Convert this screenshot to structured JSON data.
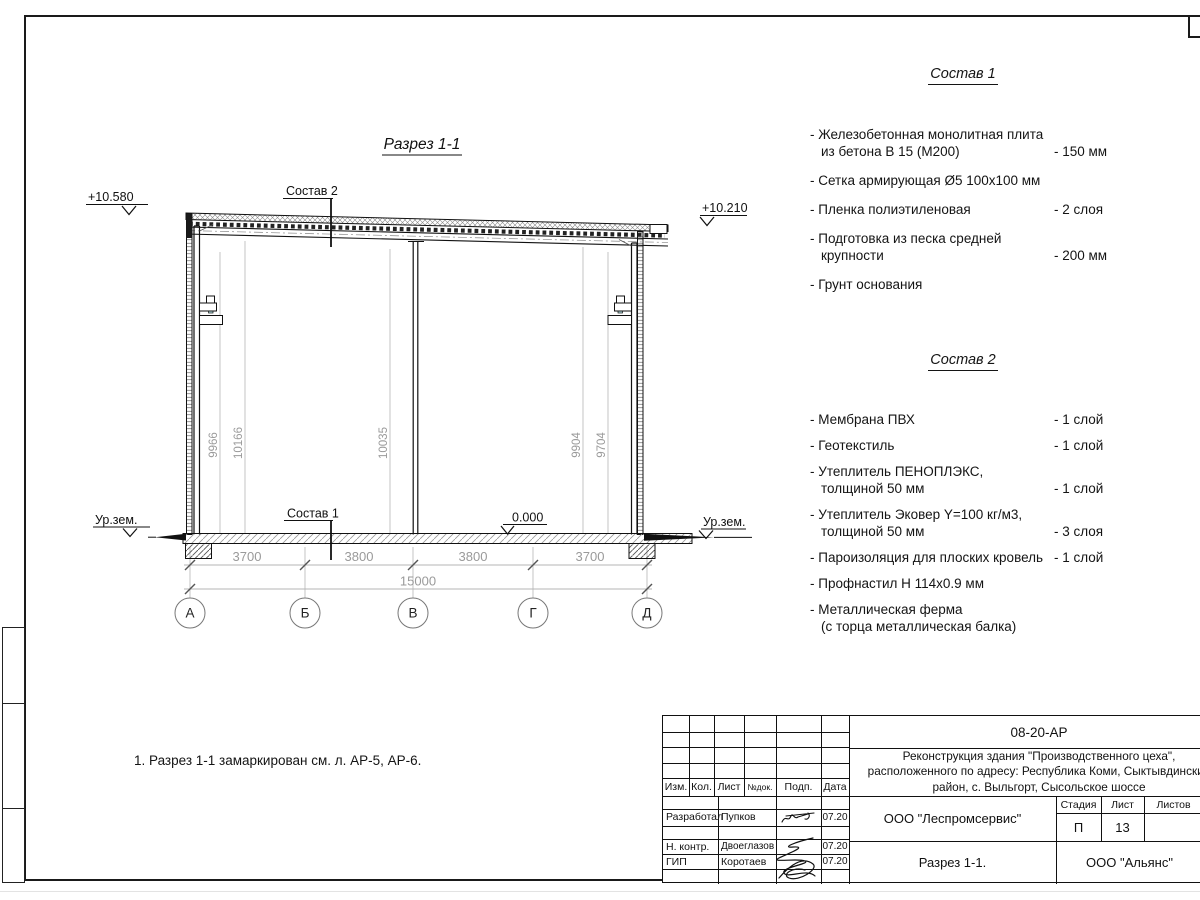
{
  "colors": {
    "line": "#1a1a1a",
    "dim_gray": "#9a9a9a",
    "bracket_accent": "#b7e4e6"
  },
  "drawing": {
    "title": "Разрез 1-1",
    "labels": {
      "comp2_ref": "Состав 2",
      "comp1_ref": "Состав 1"
    },
    "elevations": {
      "left_top": "+10.580",
      "right_top": "+10.210",
      "floor": "0.000",
      "ground_left": "Ур.зем.",
      "ground_right": "Ур.зем."
    },
    "vertical_dims": [
      "9966",
      "10166",
      "10035",
      "9904",
      "9704"
    ],
    "dims_row1": [
      "3700",
      "3800",
      "3800",
      "3700"
    ],
    "dim_total": "15000",
    "axes": [
      "А",
      "Б",
      "В",
      "Г",
      "Д"
    ]
  },
  "comp1": {
    "title": "Состав 1",
    "items": [
      {
        "name": "- Железобетонная  монолитная плита\nиз бетона В 15 (М200)",
        "value": "- 150 мм"
      },
      {
        "name": "- Сетка армирующая Ø5 100х100 мм",
        "value": ""
      },
      {
        "name": "- Пленка полиэтиленовая",
        "value": "-  2 слоя"
      },
      {
        "name": "- Подготовка из песка средней\nкрупности",
        "value": "- 200 мм"
      },
      {
        "name": "- Грунт основания",
        "value": ""
      }
    ]
  },
  "comp2": {
    "title": "Состав 2",
    "items": [
      {
        "name": "- Мембрана ПВХ",
        "value": "- 1 слой"
      },
      {
        "name": "- Геотекстиль",
        "value": "- 1 слой"
      },
      {
        "name": "- Утеплитель ПЕНОПЛЭКС,\nтолщиной 50 мм",
        "value": "- 1 слой"
      },
      {
        "name": "- Утеплитель Эковер Y=100 кг/м3,\nтолщиной 50 мм",
        "value": "- 3 слоя"
      },
      {
        "name": "- Пароизоляция для плоских кровель",
        "value": "- 1 слой"
      },
      {
        "name": "- Профнастил Н 114х0.9 мм",
        "value": ""
      },
      {
        "name": "- Металлическая ферма\n(с торца металлическая балка)",
        "value": ""
      }
    ]
  },
  "note": "1. Разрез 1-1 замаркирован см. л. АР-5, АР-6.",
  "titleblock": {
    "doc_number": "08-20-АР",
    "project": "Реконструкция здания \"Производственного цеха\",\nрасположенного по адресу: Республика Коми, Сыктывдинский\nрайон, с. Выльгорт, Сысольское шоссе",
    "cols": {
      "izm": "Изм.",
      "kol": "Кол.",
      "list": "Лист",
      "ndok": "№док.",
      "podp": "Подп.",
      "data": "Дата"
    },
    "rows": [
      {
        "role": "Разработал",
        "name": "Пупков",
        "date": "07.20"
      },
      {
        "role": "Н. контр.",
        "name": "Двоеглазов",
        "date": "07.20"
      },
      {
        "role": "ГИП",
        "name": "Коротаев",
        "date": "07.20"
      }
    ],
    "org1": "ООО \"Леспромсервис\"",
    "stage_label": "Стадия",
    "sheet_label": "Лист",
    "sheets_label": "Листов",
    "stage": "П",
    "sheet": "13",
    "drawing_name": "Разрез 1-1.",
    "org2": "ООО \"Альянс\""
  }
}
